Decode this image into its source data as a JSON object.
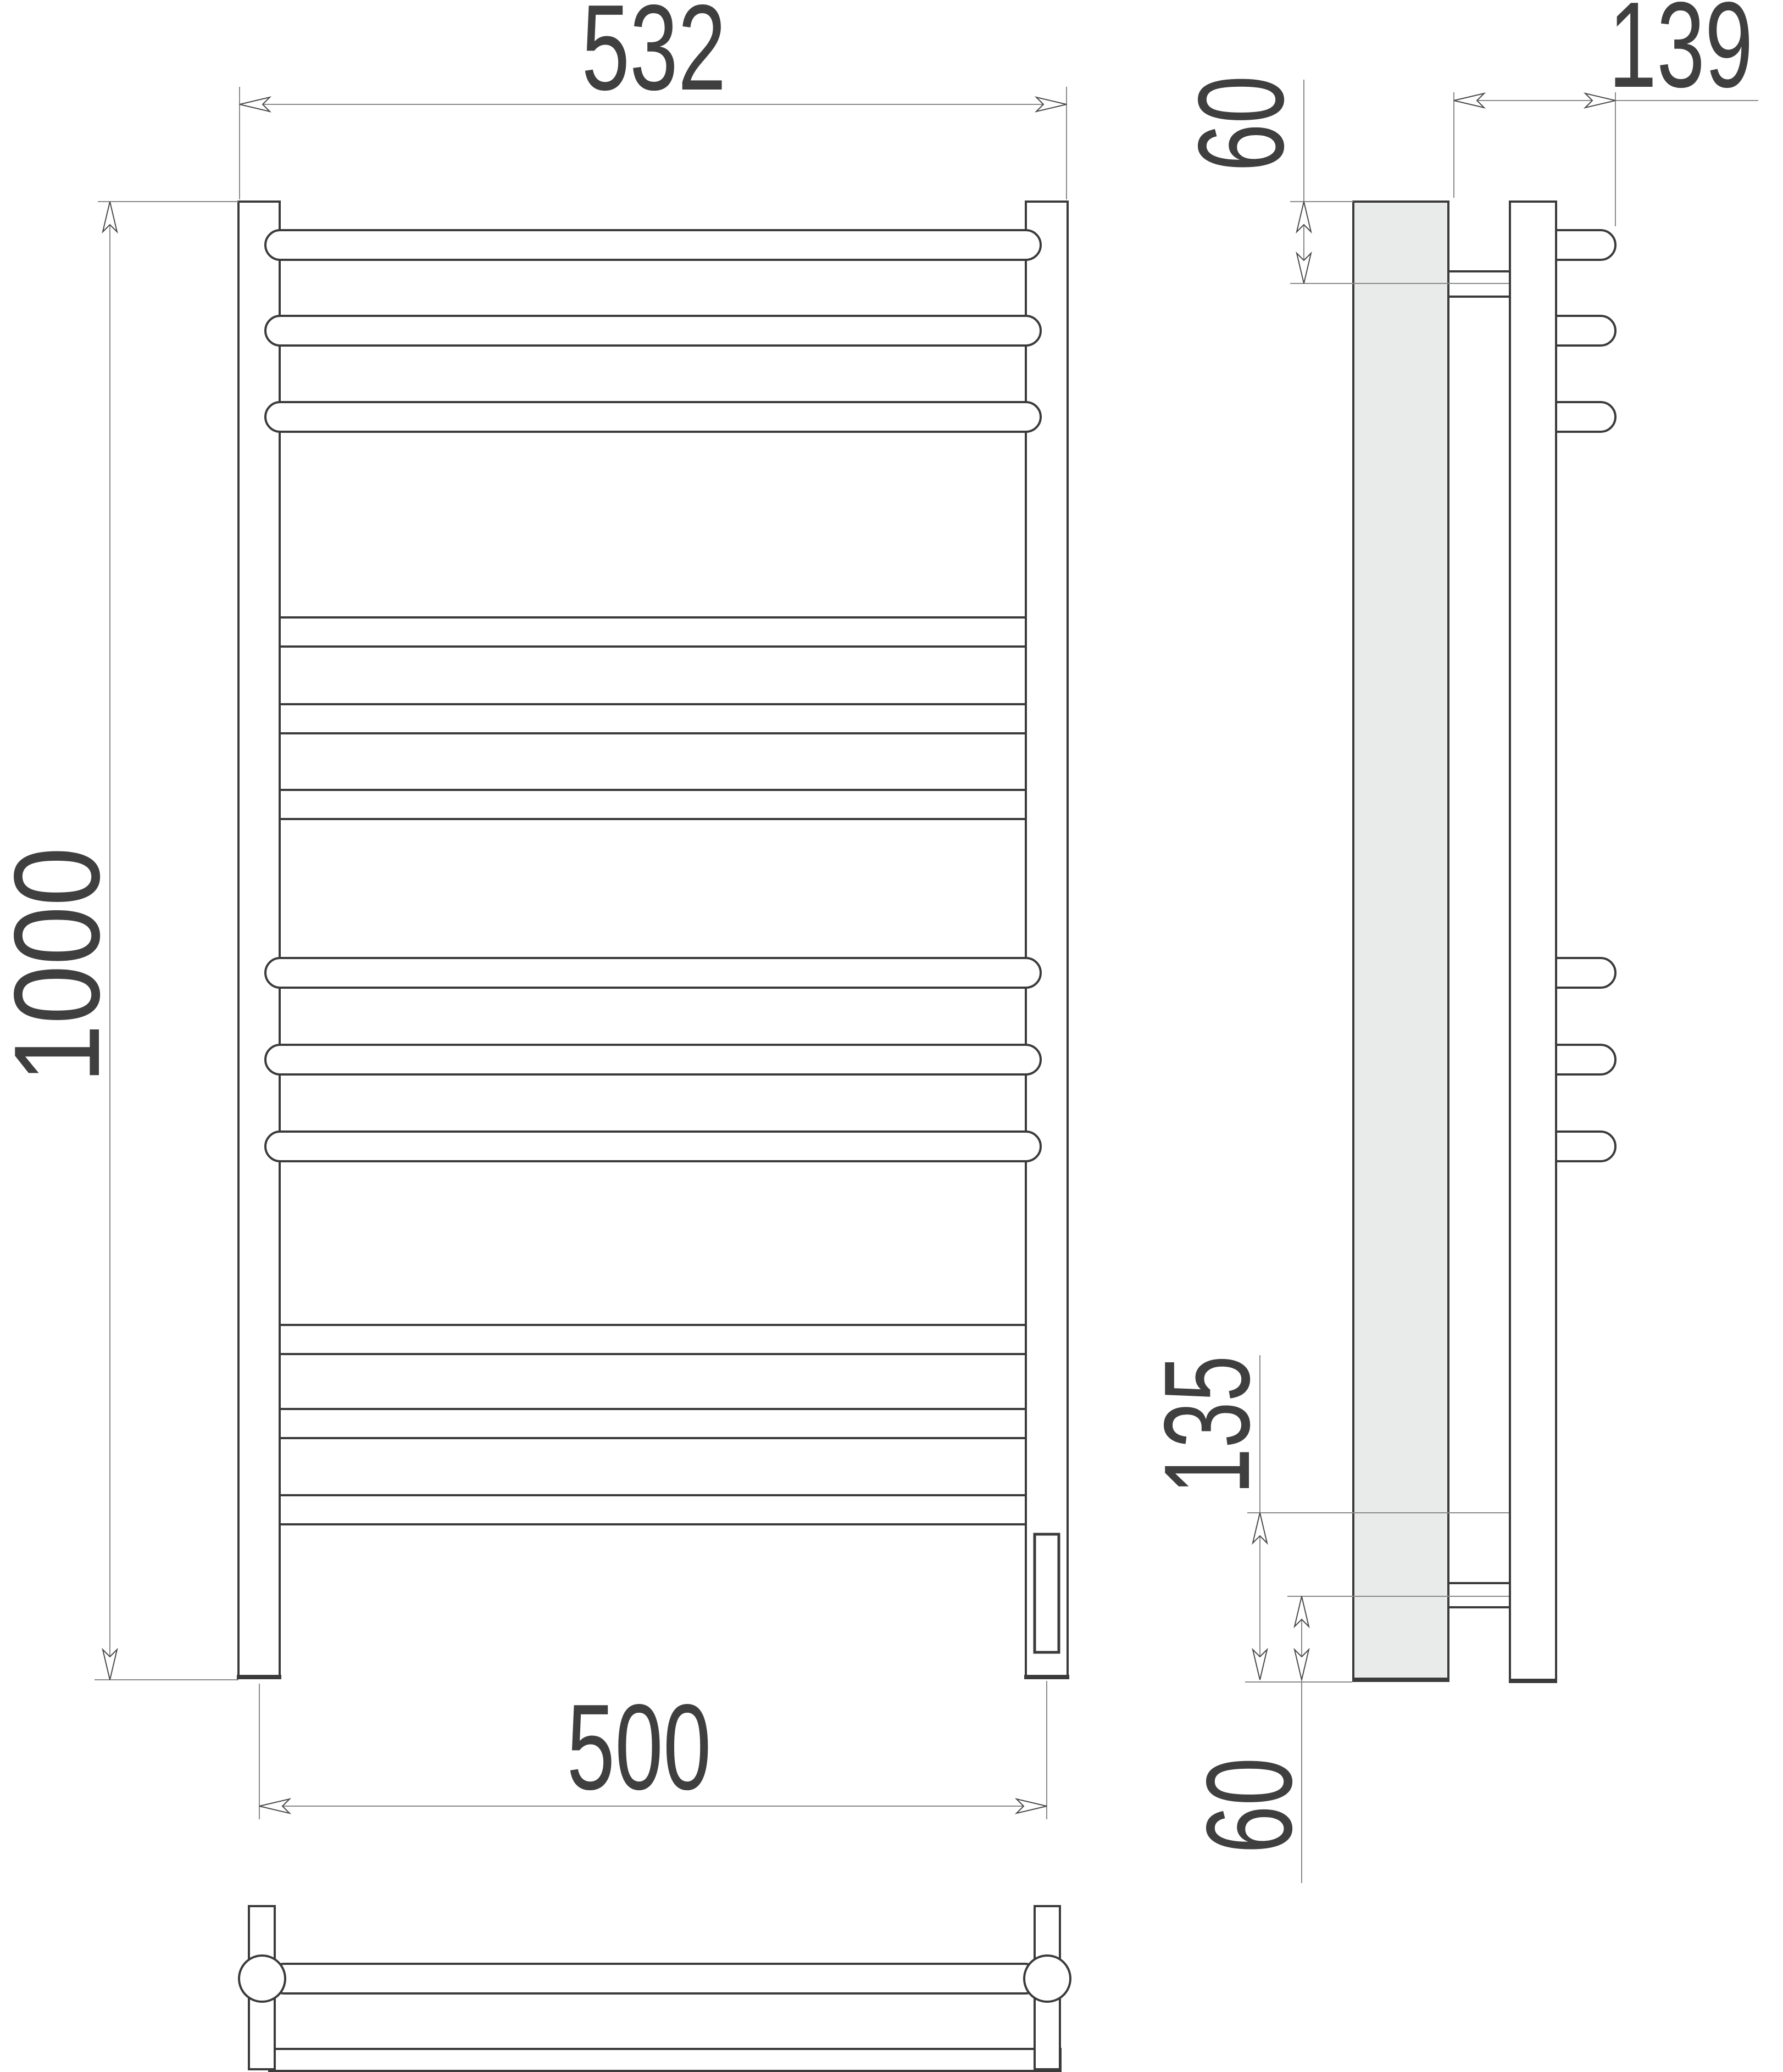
{
  "drawing": {
    "kind": "technical dimension drawing of a ladder-style heated towel rail",
    "views": {
      "front": {
        "rungs_total": 12,
        "rungs_long_protruding": 6,
        "rungs_short": 6,
        "posts": 2,
        "heating_element_in_right_post": true
      },
      "side": {
        "wall_profile_filled": true,
        "brackets": 2,
        "rung_stubs": 6
      },
      "plan": {
        "post_circles": 2,
        "rung_bar": 1,
        "wall_profile_bar": 1,
        "bracket_feet": 2
      }
    },
    "dimensions": {
      "overall_width": {
        "value": 532,
        "label": "532",
        "units": "mm",
        "where": "front view, top"
      },
      "overall_height": {
        "value": 1000,
        "label": "1000",
        "units": "mm",
        "where": "front view, left, rotated"
      },
      "mount_centers_width": {
        "value": 500,
        "label": "500",
        "units": "mm",
        "where": "front view, bottom"
      },
      "top_bracket_offset": {
        "value": 60,
        "label": "60",
        "units": "mm",
        "where": "side view, top, rotated"
      },
      "depth": {
        "value": 139,
        "label": "139",
        "units": "mm",
        "where": "side view, top right"
      },
      "bottom_rung_offset": {
        "value": 135,
        "label": "135",
        "units": "mm",
        "where": "side view, bottom, rotated"
      },
      "bottom_bracket_offset": {
        "value": 60,
        "label": "60",
        "units": "mm",
        "where": "side view, bottom, rotated"
      }
    },
    "colors": {
      "outline": "#3b3b3b",
      "dimension_lines": "#8a8a8a",
      "wall_profile_fill": "#e9eaea",
      "text": "#3f3f3f",
      "background": "#ffffff"
    }
  }
}
